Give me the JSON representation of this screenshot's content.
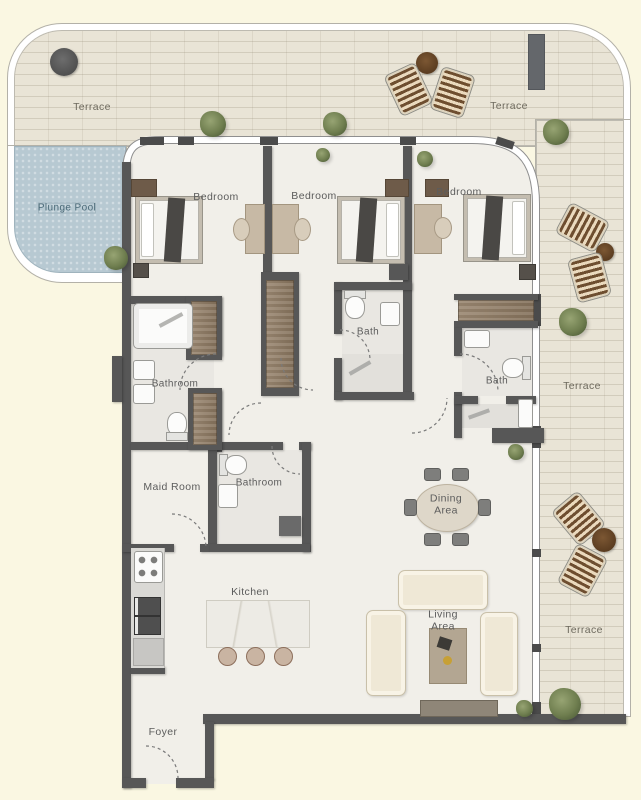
{
  "title": "Apartment Floor Plan",
  "labels": {
    "terrace_top_left": "Terrace",
    "terrace_top_right": "Terrace",
    "terrace_right_upper": "Terrace",
    "terrace_right_lower": "Terrace",
    "plunge_pool": "Plunge Pool",
    "bedroom_left": "Bedroom",
    "bedroom_middle": "Bedroom",
    "bedroom_right": "Bedroom",
    "bathroom_master": "Bathroom",
    "bath_middle": "Bath",
    "bath_right": "Bath",
    "maid_room": "Maid Room",
    "bathroom_maid": "Bathroom",
    "kitchen": "Kitchen",
    "dining_line1": "Dining",
    "dining_line2": "Area",
    "living_line1": "Living",
    "living_line2": "Area",
    "foyer": "Foyer"
  },
  "colors": {
    "background": "#faf7e2",
    "wall": "#575757",
    "terrace_floor": "#e9e4d6",
    "interior_floor": "#f1efe9",
    "pool_water": "#b7c9d2",
    "glass_wall": "#ffffff",
    "wood_wardrobe": "#8d7a63",
    "label_text": "#5c5c5c"
  }
}
